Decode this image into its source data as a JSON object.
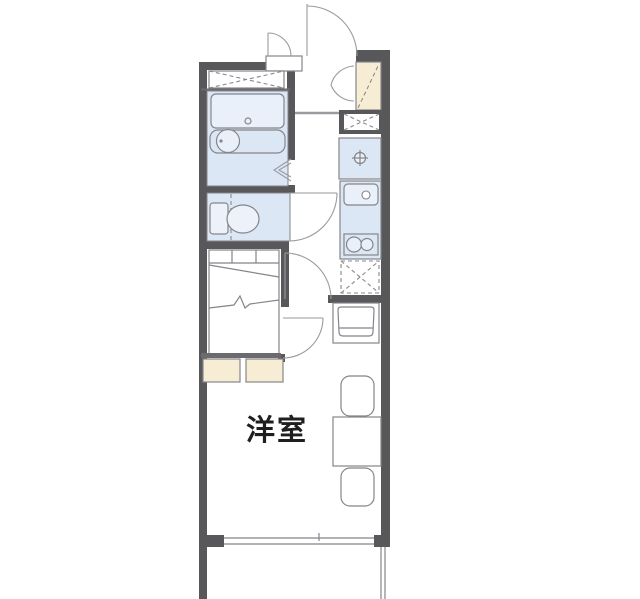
{
  "title": "1K apartment floor plan",
  "room_label": "洋室",
  "colors": {
    "wall": "#58585b",
    "mid": "#6b6b6e",
    "line": "#85858a",
    "light_line": "#9a9aa0",
    "dash": "#8a8a8e",
    "blue": "#dbe7f4",
    "blue_light": "#eaf0f9",
    "cream": "#f7edd4",
    "text": "#1f1f1f",
    "bg": "#ffffff"
  },
  "rooms": [
    {
      "name": "western-room",
      "label": "洋室"
    },
    {
      "name": "bathroom"
    },
    {
      "name": "toilet-room"
    },
    {
      "name": "kitchen-corridor"
    },
    {
      "name": "entrance"
    },
    {
      "name": "balcony"
    },
    {
      "name": "bed-nook"
    }
  ],
  "fixtures": [
    "entrance-door",
    "meter-box-door",
    "shoe-cabinet",
    "storage-closet-x",
    "pipe-space-x",
    "water-heater-unit",
    "kitchen-sink",
    "gas-stove-2-burner",
    "refrigerator-space",
    "washing-machine-space",
    "bathtub",
    "wash-basin",
    "folding-bath-door",
    "toilet",
    "bed",
    "under-bed-storage",
    "table",
    "chair",
    "sliding-window",
    "balcony-rail"
  ]
}
